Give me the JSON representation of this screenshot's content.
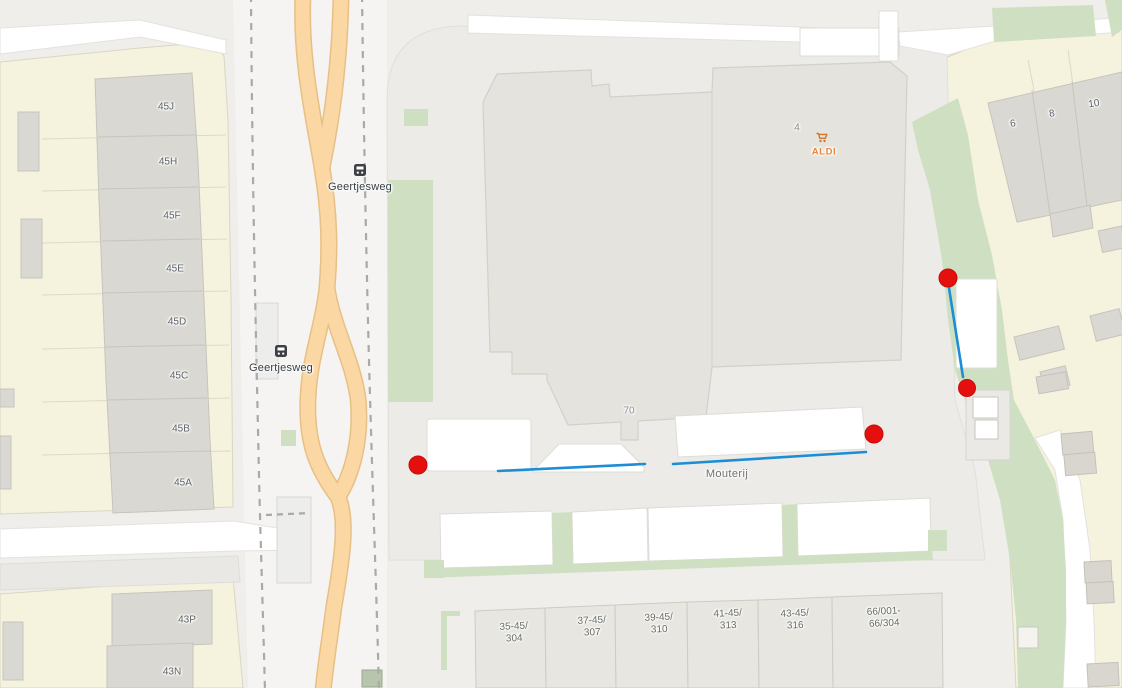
{
  "map_labels": {
    "bus_stops": [
      {
        "name": "Geertjesweg"
      },
      {
        "name": "Geertjesweg"
      }
    ],
    "street_name": "Mouterij",
    "poi": {
      "name": "ALDI",
      "house_number": "4"
    },
    "house_number_70": "70",
    "left_house_numbers": [
      "45J",
      "45H",
      "45F",
      "45E",
      "45D",
      "45C",
      "45B",
      "45A"
    ],
    "lower_left_house_numbers": [
      "43P",
      "43N"
    ],
    "right_house_numbers": [
      "6",
      "8",
      "10"
    ],
    "bottom_address_blocks": [
      "35-45/\n304",
      "37-45/\n307",
      "39-45/\n310",
      "41-45/\n313",
      "43-45/\n316",
      "66/001-\n66/304"
    ]
  },
  "annotations": {
    "red_marker_count": 4,
    "blue_segment_count": 3
  },
  "colors": {
    "background_gray": "#efeeea",
    "parcel_beige": "#f5f3de",
    "building_gray": "#dad8d2",
    "large_building_gray": "#e5e3dd",
    "green_area": "#cfe0c2",
    "road_orange": "#fbd7a3",
    "railway_gray": "#a9a9a9",
    "annotation_blue": "#1d8ed5",
    "marker_red": "#e5100e",
    "aldi_orange": "#e8873c"
  }
}
